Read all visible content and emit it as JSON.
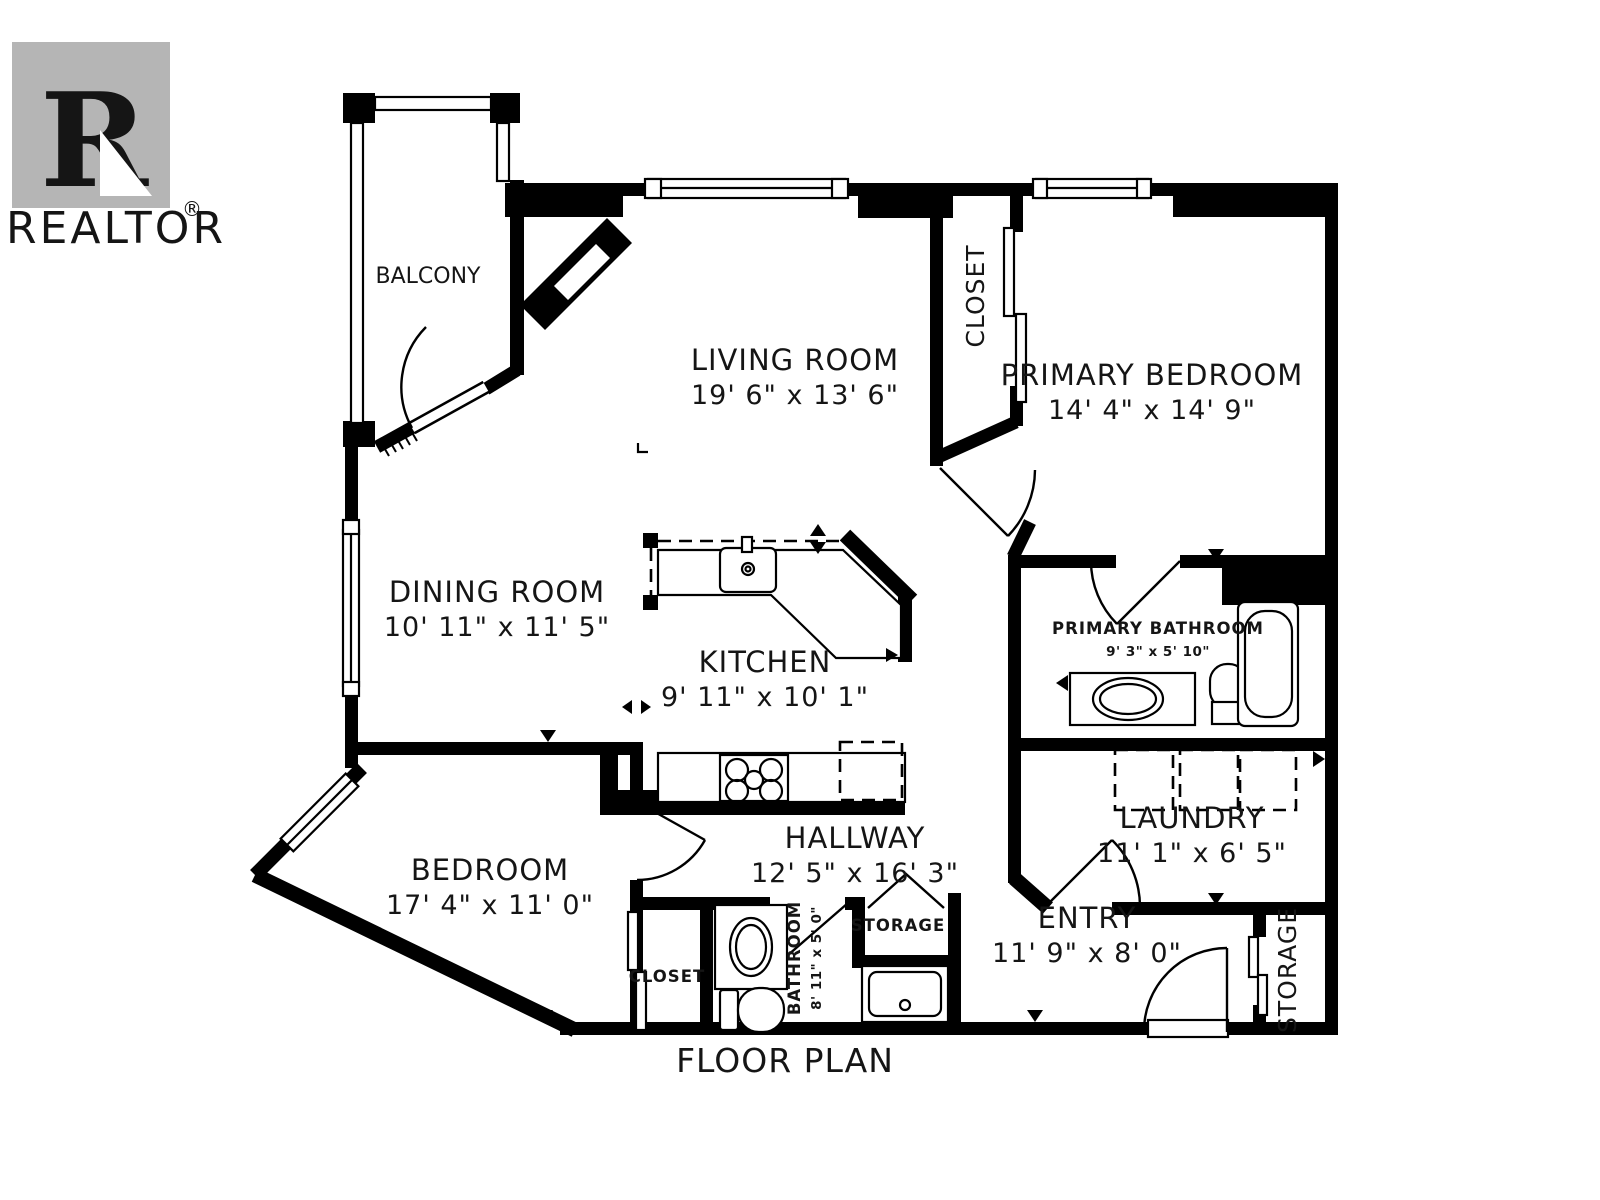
{
  "title": "FLOOR PLAN",
  "watermark": {
    "letter": "R",
    "label": "REALTOR",
    "registered": "®"
  },
  "colors": {
    "walls": "#000000",
    "background": "#ffffff",
    "watermark": "#b5b5b5"
  },
  "rooms": {
    "balcony": {
      "name": "BALCONY"
    },
    "living_room": {
      "name": "LIVING ROOM",
      "dims": "19' 6\" x 13' 6\""
    },
    "closet_top": {
      "name": "CLOSET"
    },
    "primary_bedroom": {
      "name": "PRIMARY BEDROOM",
      "dims": "14' 4\" x 14' 9\""
    },
    "dining_room": {
      "name": "DINING ROOM",
      "dims": "10' 11\" x 11' 5\""
    },
    "kitchen": {
      "name": "KITCHEN",
      "dims": "9' 11\" x 10' 1\""
    },
    "primary_bathroom": {
      "name": "PRIMARY BATHROOM",
      "dims": "9' 3\" x 5' 10\""
    },
    "laundry": {
      "name": "LAUNDRY",
      "dims": "11' 1\" x 6' 5\""
    },
    "bedroom": {
      "name": "BEDROOM",
      "dims": "17' 4\" x 11' 0\""
    },
    "hallway": {
      "name": "HALLWAY",
      "dims": "12' 5\" x 16' 3\""
    },
    "storage_hall": {
      "name": "STORAGE"
    },
    "bathroom": {
      "name": "BATHROOM",
      "dims": "8' 11\" x 5' 0\""
    },
    "closet_bedroom": {
      "name": "CLOSET"
    },
    "entry": {
      "name": "ENTRY",
      "dims": "11' 9\" x 8' 0\""
    },
    "storage_entry": {
      "name": "STORAGE"
    }
  }
}
